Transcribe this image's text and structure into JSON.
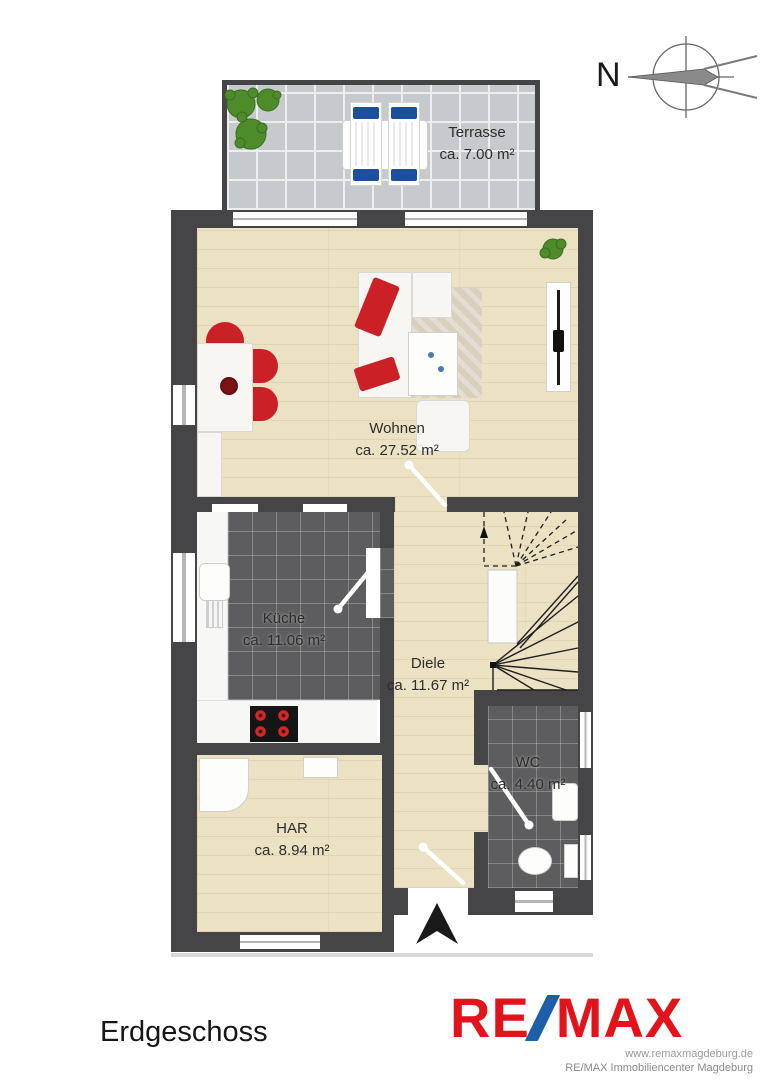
{
  "page": {
    "floor_label": "Erdgeschoss"
  },
  "compass": {
    "label": "N"
  },
  "rooms": [
    {
      "name": "Terrasse",
      "area": "ca. 7.00 m²"
    },
    {
      "name": "Wohnen",
      "area": "ca. 27.52 m²"
    },
    {
      "name": "Küche",
      "area": "ca. 11.06 m²"
    },
    {
      "name": "Diele",
      "area": "ca. 11.67 m²"
    },
    {
      "name": "WC",
      "area": "ca. 4.40 m²"
    },
    {
      "name": "HAR",
      "area": "ca. 8.94 m²"
    }
  ],
  "branding": {
    "logo_re": "RE",
    "logo_max": "MAX",
    "website": "www.remaxmagdeburg.de",
    "company": "RE/MAX Immobiliencenter Magdeburg",
    "logo_red": "#e2131b",
    "logo_blue": "#1b5fa8"
  },
  "colors": {
    "wall": "#454547",
    "wood_floor": "#ebe1c3",
    "dark_tile": "#5d5d5f",
    "terrace_tile": "#c7cacc",
    "accent_red": "#cc2027",
    "plant_green": "#4e8c2a"
  }
}
